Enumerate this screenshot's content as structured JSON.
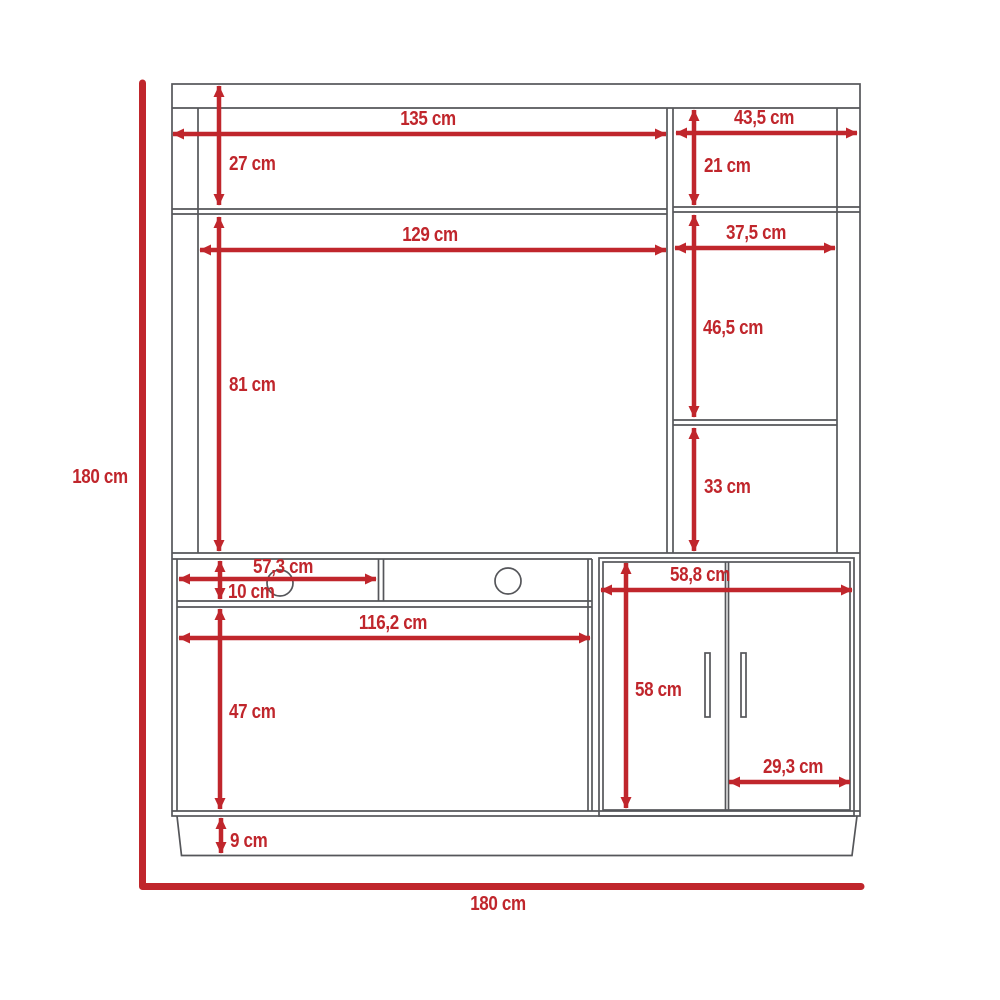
{
  "diagram": {
    "kind": "furniture-dimension-drawing",
    "unit": "cm",
    "colors": {
      "dimension_red": "#c0262c",
      "outline_gray": "#55565a",
      "background": "#ffffff"
    }
  },
  "dimensions": {
    "overall_height": "180 cm",
    "overall_width": "180 cm",
    "top_left_shelf_width": "135 cm",
    "top_left_shelf_height": "27 cm",
    "top_right_shelf_width": "43,5 cm",
    "top_right_shelf_height": "21 cm",
    "tv_compartment_width": "129 cm",
    "right_column_width": "37,5 cm",
    "tv_compartment_height": "81 cm",
    "right_upper_compartment_height": "46,5 cm",
    "right_lower_compartment_height": "33 cm",
    "media_shelf_left_width": "57,3 cm",
    "media_shelf_height": "10 cm",
    "lower_compartment_width": "116,2 cm",
    "lower_compartment_height": "47 cm",
    "door_cabinet_width": "58,8 cm",
    "door_cabinet_height": "58 cm",
    "door_width": "29,3 cm",
    "base_height": "9 cm"
  }
}
